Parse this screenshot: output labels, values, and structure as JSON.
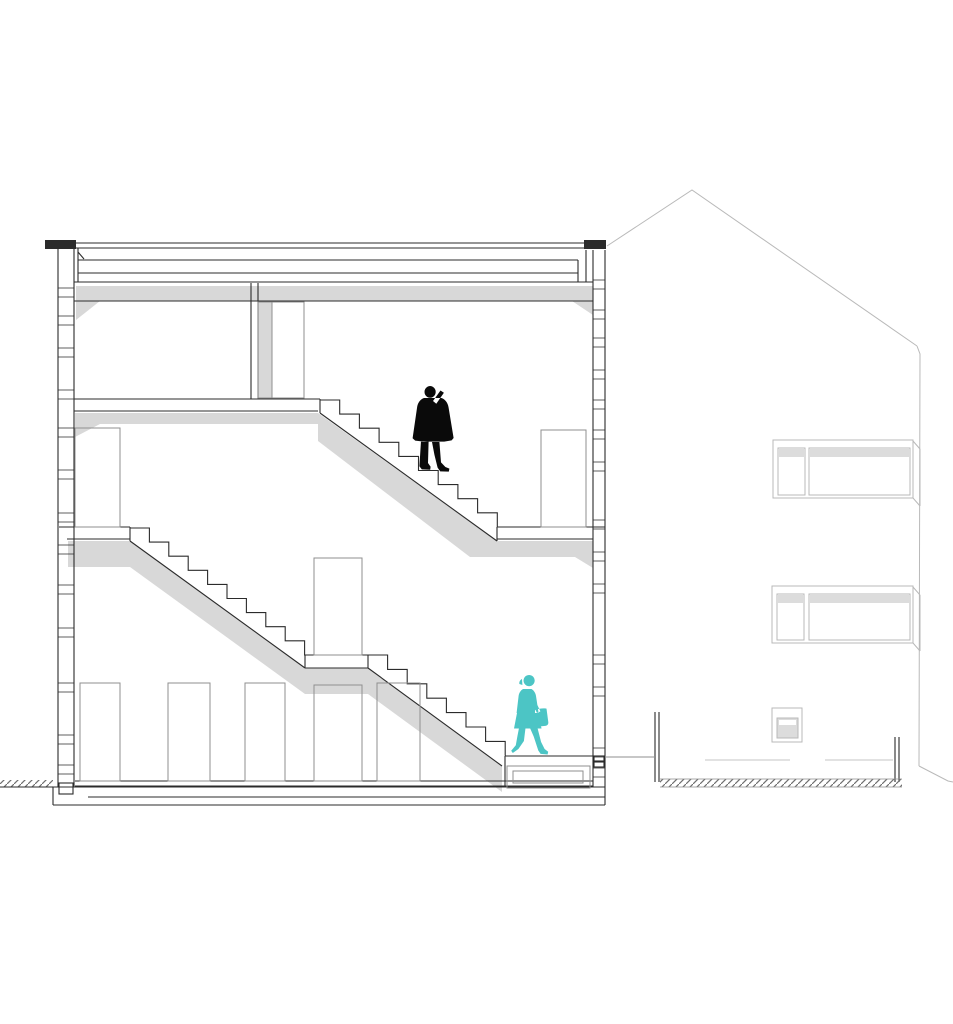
{
  "meta": {
    "title": "Architectural building section drawing",
    "description": "Black-and-white cross-section of a multi-storey house with two switchback stair flights, gray poche floor slabs, door openings, a black silhouette standing on the upper stair, a teal woman with a shoulder bag walking at the entrance level, and the neighbouring gabled building drawn in light gray elevation at right."
  },
  "colors": {
    "background": "#ffffff",
    "section_line": "#2b2b2b",
    "detail_line": "#8f8f8f",
    "elevation_line": "#b9b9b9",
    "terrace_line": "#c4c4c4",
    "poche_gray": "#d8d8d8",
    "glass_gray": "#dcdcdc",
    "white": "#ffffff",
    "ground_hatch": "#6e6e6e",
    "figure_black": "#0a0a0a",
    "figure_teal": "#4cc5c5"
  },
  "figures": {
    "standing_person": "black silhouette standing on the upper stair flight",
    "walking_person": "teal silhouette walking at the entrance level carrying a shoulder bag"
  }
}
